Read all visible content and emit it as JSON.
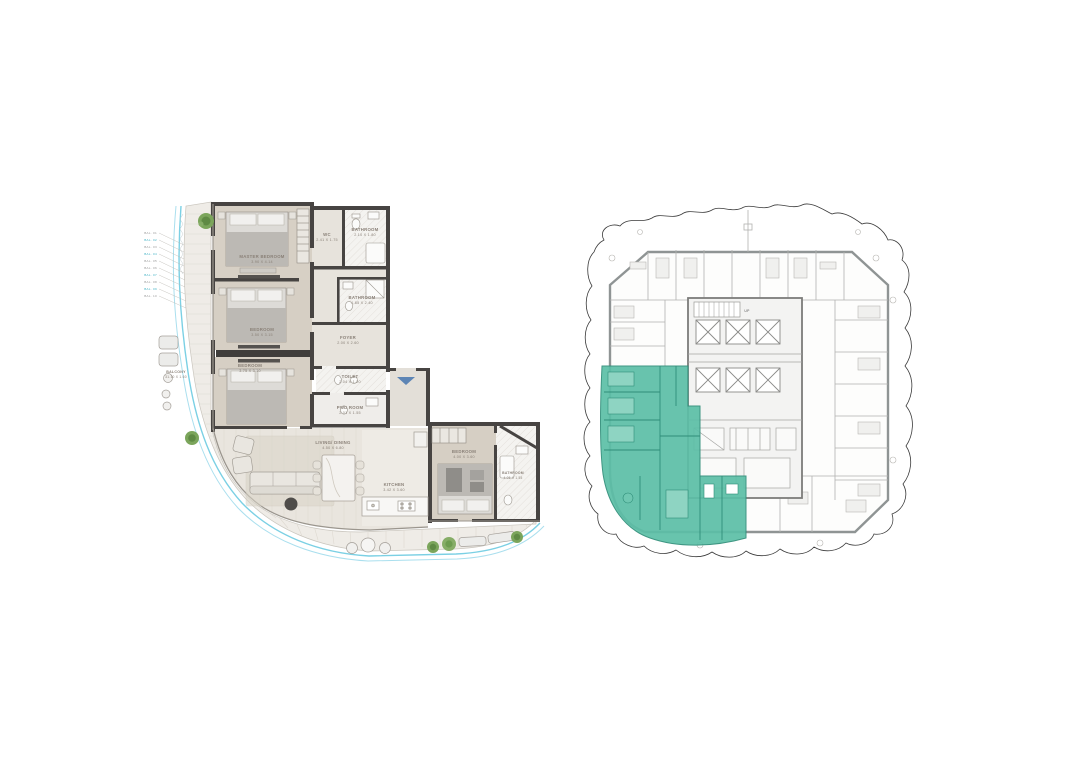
{
  "page": {
    "background": "#ffffff",
    "description": "apartment floor plan with key plan"
  },
  "colors": {
    "wall_dark": "#474442",
    "floor_bedroom": "#d7d0c5",
    "floor_hall": "#e7e3dc",
    "floor_living": "#e9e5de",
    "floor_balcony": "#efece7",
    "tile": "#f4f3f0",
    "pool_blue": "#7bd0e4",
    "pool_blue_light": "#aadfee",
    "tree_green": "#6d9c50",
    "entry_arrow": "#5d85b5",
    "keyplan_line": "#8f9494",
    "highlight_teal": "#5cbfa7",
    "highlight_teal_dark": "#2f8e79"
  },
  "unit_plan": {
    "rooms": {
      "master_bedroom": {
        "name": "MASTER BEDROOM",
        "dims": "3.90 X 4.14"
      },
      "wc": {
        "name": "WC",
        "dims": "2.41 X 1.75"
      },
      "bathroom_top": {
        "name": "BATHROOM",
        "dims": "2.10 X 1.80"
      },
      "bedroom_2": {
        "name": "BEDROOM",
        "dims": "3.50 X 3.15"
      },
      "bathroom_mid": {
        "name": "BATHROOM",
        "dims": "1.85 X 2.40"
      },
      "foyer": {
        "name": "FOYER",
        "dims": "2.00 X 2.60"
      },
      "toilet": {
        "name": "TOILET",
        "dims": "2.04 X 1.20"
      },
      "bedroom_3": {
        "name": "BEDROOM",
        "dims": "3.75 X 3.10"
      },
      "pwd_room": {
        "name": "PWD ROOM",
        "dims": "2.01 X 1.55"
      },
      "living_dining": {
        "name": "LIVING/ DINING",
        "dims": "4.50 X 6.80"
      },
      "kitchen": {
        "name": "KITCHEN",
        "dims": "3.42 X 3.60"
      },
      "bedroom_4": {
        "name": "BEDROOM",
        "dims": "4.00 X 3.60"
      },
      "bathroom_right": {
        "name": "BATHROOM",
        "dims": "4.05 X 1.55"
      },
      "balcony": {
        "name": "BALCONY",
        "dims": "31.10 X 1.60"
      }
    },
    "callouts": [
      "BAL. 01",
      "BAL. 02",
      "BAL. 03",
      "BAL. 04",
      "BAL. 05",
      "BAL. 06",
      "BAL. 07",
      "BAL. 08",
      "BAL. 09",
      "BAL. 10"
    ]
  },
  "key_plan": {
    "up_label": "UP",
    "highlighted_unit": "lower-left corner unit shaded teal"
  }
}
